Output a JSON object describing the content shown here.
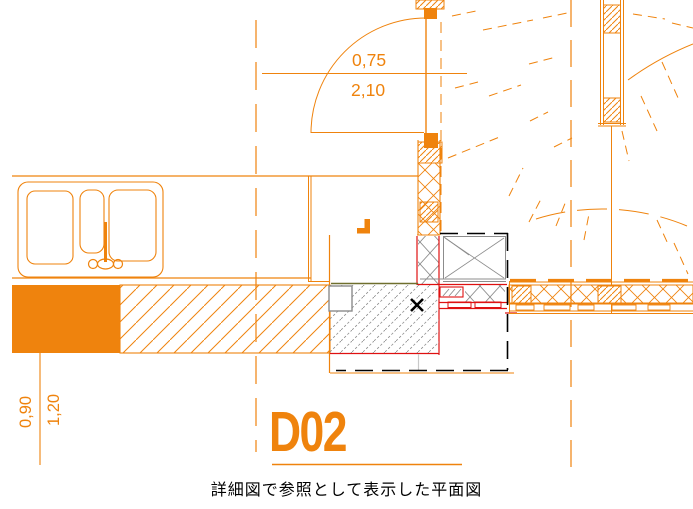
{
  "drawing": {
    "door_label": "D02",
    "dim_door_width": "0,75",
    "dim_door_height": "2,10",
    "dim_left_inner": "0,90",
    "dim_left_outer": "1,20",
    "caption": "詳細図で参照として表示した平面図"
  },
  "colors": {
    "orange": "#EF830D",
    "red": "#DF1010",
    "grey": "#8C8C8C",
    "olive": "#6F6F2D",
    "lightgrey": "#C9C9C9",
    "black": "#000000"
  }
}
